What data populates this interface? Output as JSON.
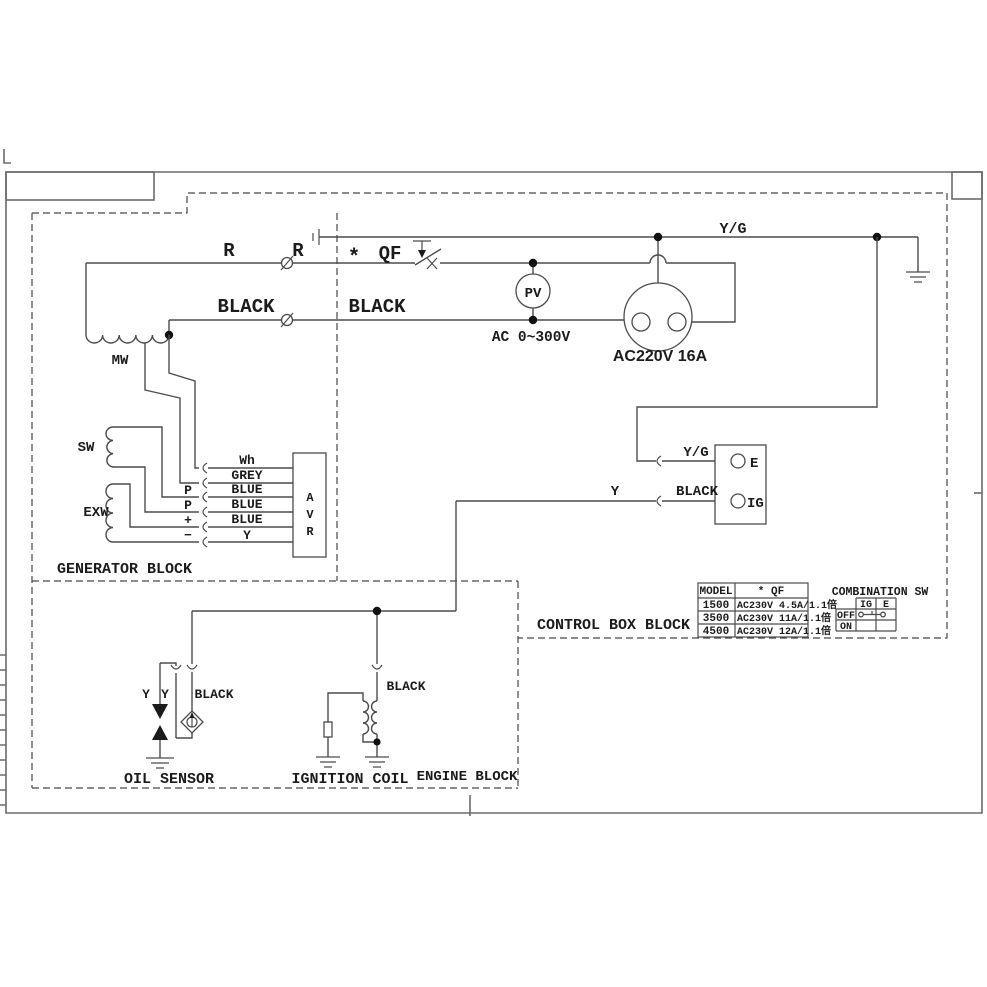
{
  "labels": {
    "r_left": "R",
    "r_right": "R",
    "star": "*",
    "qf": "QF",
    "black_left": "BLACK",
    "black_right": "BLACK",
    "pv": "PV",
    "pv_range": "AC 0~300V",
    "socket": "AC220V 16A",
    "yg_top": "Y/G",
    "mw": "MW",
    "sw": "SW",
    "exw": "EXW",
    "avr": [
      "A",
      "V",
      "R"
    ],
    "wire_wh": "Wh",
    "wire_grey": "GREY",
    "wire_blue1": "BLUE",
    "wire_blue2": "BLUE",
    "wire_blue3": "BLUE",
    "wire_y": "Y",
    "pin_p1": "P",
    "pin_p2": "P",
    "pin_plus": "+",
    "pin_minus": "−",
    "generator_block": "GENERATOR BLOCK",
    "yg_e": "Y/G",
    "y_ig": "Y",
    "black_ig": "BLACK",
    "term_e": "E",
    "term_ig": "IG",
    "control_block": "CONTROL BOX BLOCK",
    "oil_y1": "Y",
    "oil_y2": "Y",
    "oil_black": "BLACK",
    "oil_sensor": "OIL SENSOR",
    "ign_black": "BLACK",
    "ignition_coil": "IGNITION COIL",
    "engine_block": "ENGINE BLOCK"
  },
  "model_table": {
    "headers": [
      "MODEL",
      "* QF"
    ],
    "rows": [
      [
        "1500",
        "AC230V 4.5A/1.1倍"
      ],
      [
        "3500",
        "AC230V 11A/1.1倍"
      ],
      [
        "4500",
        "AC230V 12A/1.1倍"
      ]
    ]
  },
  "combination_sw": {
    "title": "COMBINATION SW",
    "cols": [
      "IG",
      "E"
    ],
    "rows": [
      "OFF",
      "ON"
    ]
  },
  "colors": {
    "line": "#4c4c4c",
    "text": "#1b1b1b",
    "background": "#ffffff"
  }
}
